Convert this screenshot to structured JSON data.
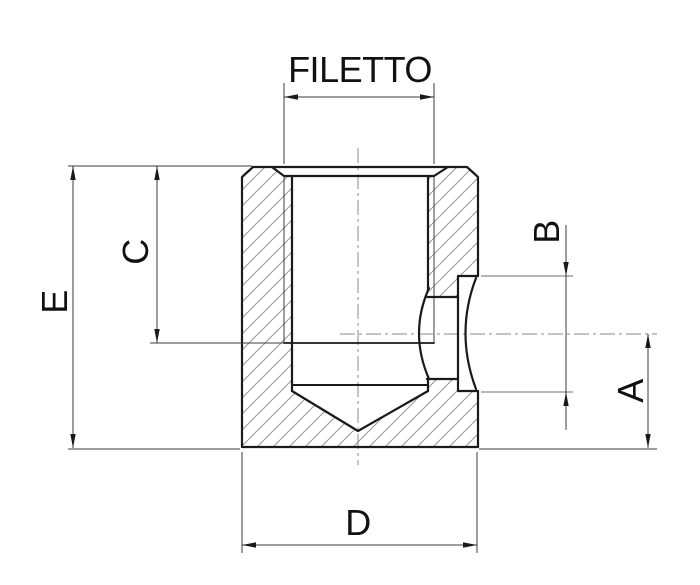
{
  "drawing": {
    "type": "technical-section-drawing",
    "labels": {
      "thread": "FILETTO",
      "height_overall": "E",
      "thread_depth": "C",
      "spotface_width": "B",
      "hole_height": "A",
      "outer_diameter": "D"
    },
    "colors": {
      "outline": "#1a1a1a",
      "hatch": "#9a9a9a",
      "dimension_line": "#3c3c3c",
      "centerline": "#8a8a8a",
      "background": "#ffffff"
    }
  }
}
